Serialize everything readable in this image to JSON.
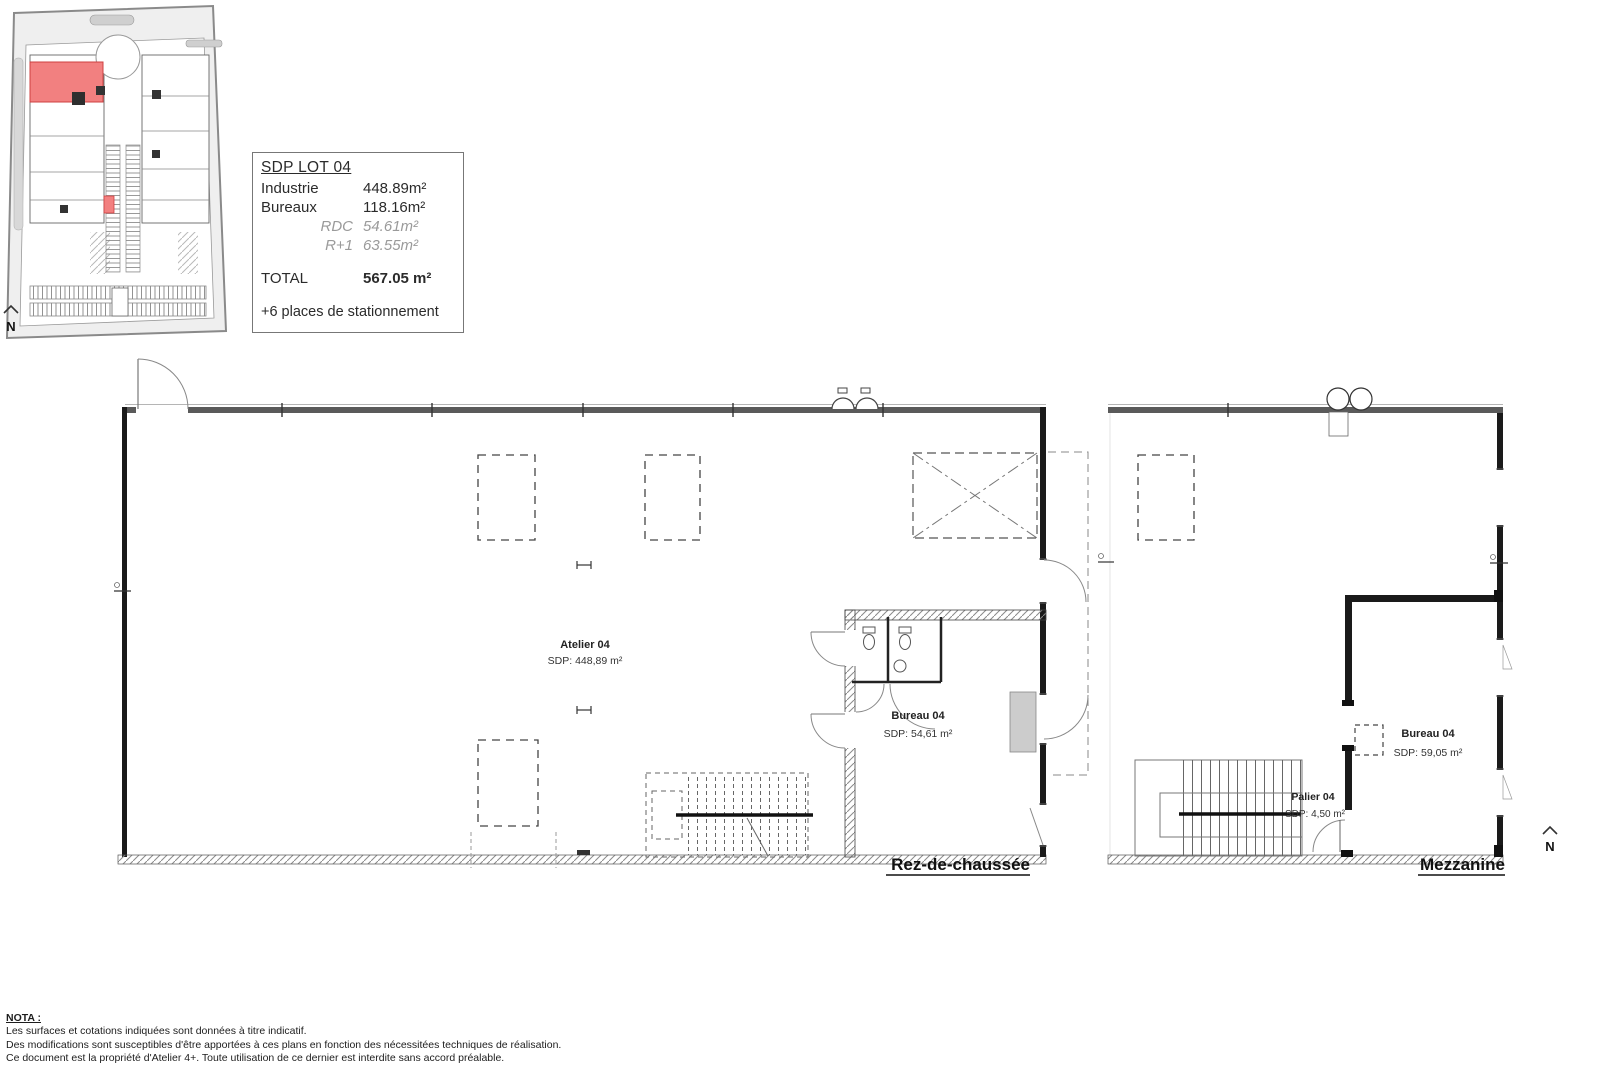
{
  "site_plan": {
    "north_label": "N"
  },
  "info_box": {
    "title": "SDP LOT 04",
    "rows": [
      {
        "label": "Industrie",
        "value": "448.89m²"
      },
      {
        "label": "Bureaux",
        "value": "118.16m²"
      },
      {
        "label": "RDC",
        "value": "54.61m²"
      },
      {
        "label": "R+1",
        "value": "63.55m²"
      }
    ],
    "total_label": "TOTAL",
    "total_value": "567.05 m²",
    "parking_note": "+6 places de stationnement"
  },
  "rdc_plan": {
    "title": "Rez-de-chaussée",
    "atelier_name": "Atelier 04",
    "atelier_area": "SDP: 448,89 m²",
    "bureau_name": "Bureau 04",
    "bureau_area": "SDP: 54,61 m²"
  },
  "mezzanine_plan": {
    "title": "Mezzanine",
    "bureau_name": "Bureau 04",
    "bureau_area": "SDP: 59,05 m²",
    "palier_name": "Palier 04",
    "palier_area": "SDP: 4,50 m²",
    "north_label": "N"
  },
  "nota": {
    "heading": "NOTA :",
    "lines": [
      "Les surfaces et cotations indiquées sont données à titre indicatif.",
      "Des modifications sont susceptibles d'être apportées à ces plans en fonction des nécessitées techniques de réalisation.",
      "Ce document est la propriété d'Atelier 4+. Toute utilisation de ce dernier est interdite sans accord préalable."
    ]
  }
}
